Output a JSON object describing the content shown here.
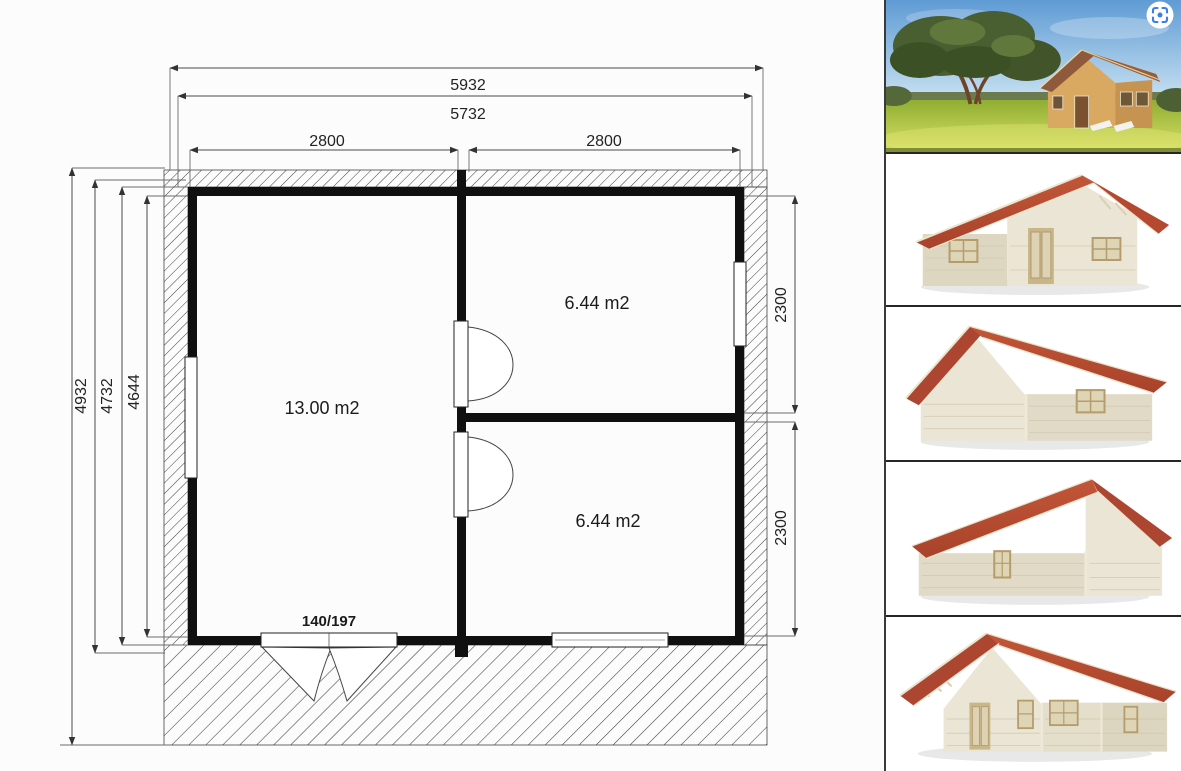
{
  "plan": {
    "dim_top_outer": "5932",
    "dim_top_wall": "5732",
    "dim_room_left": "2800",
    "dim_room_right": "2800",
    "dim_left_outer": "4932",
    "dim_left_wall": "4732",
    "dim_left_inner": "4644",
    "dim_right_top": "2300",
    "dim_right_bottom": "2300",
    "room_main": "13.00 m2",
    "room_top_right": "6.44 m2",
    "room_bottom_right": "6.44 m2",
    "door_label": "140/197"
  },
  "sidebar": {
    "accent_blue": "#3e7de8",
    "thumbnails": [
      {
        "name": "photo-cabin-in-garden"
      },
      {
        "name": "render-cabin-front"
      },
      {
        "name": "render-cabin-side-gable-left"
      },
      {
        "name": "render-cabin-back"
      },
      {
        "name": "render-cabin-front-angled"
      }
    ],
    "colors": {
      "roof_red": "#b5492f",
      "wall_cream": "#e7e3d2",
      "grass_green": "#b8cc48",
      "sky_blue": "#6fa8dc"
    }
  }
}
